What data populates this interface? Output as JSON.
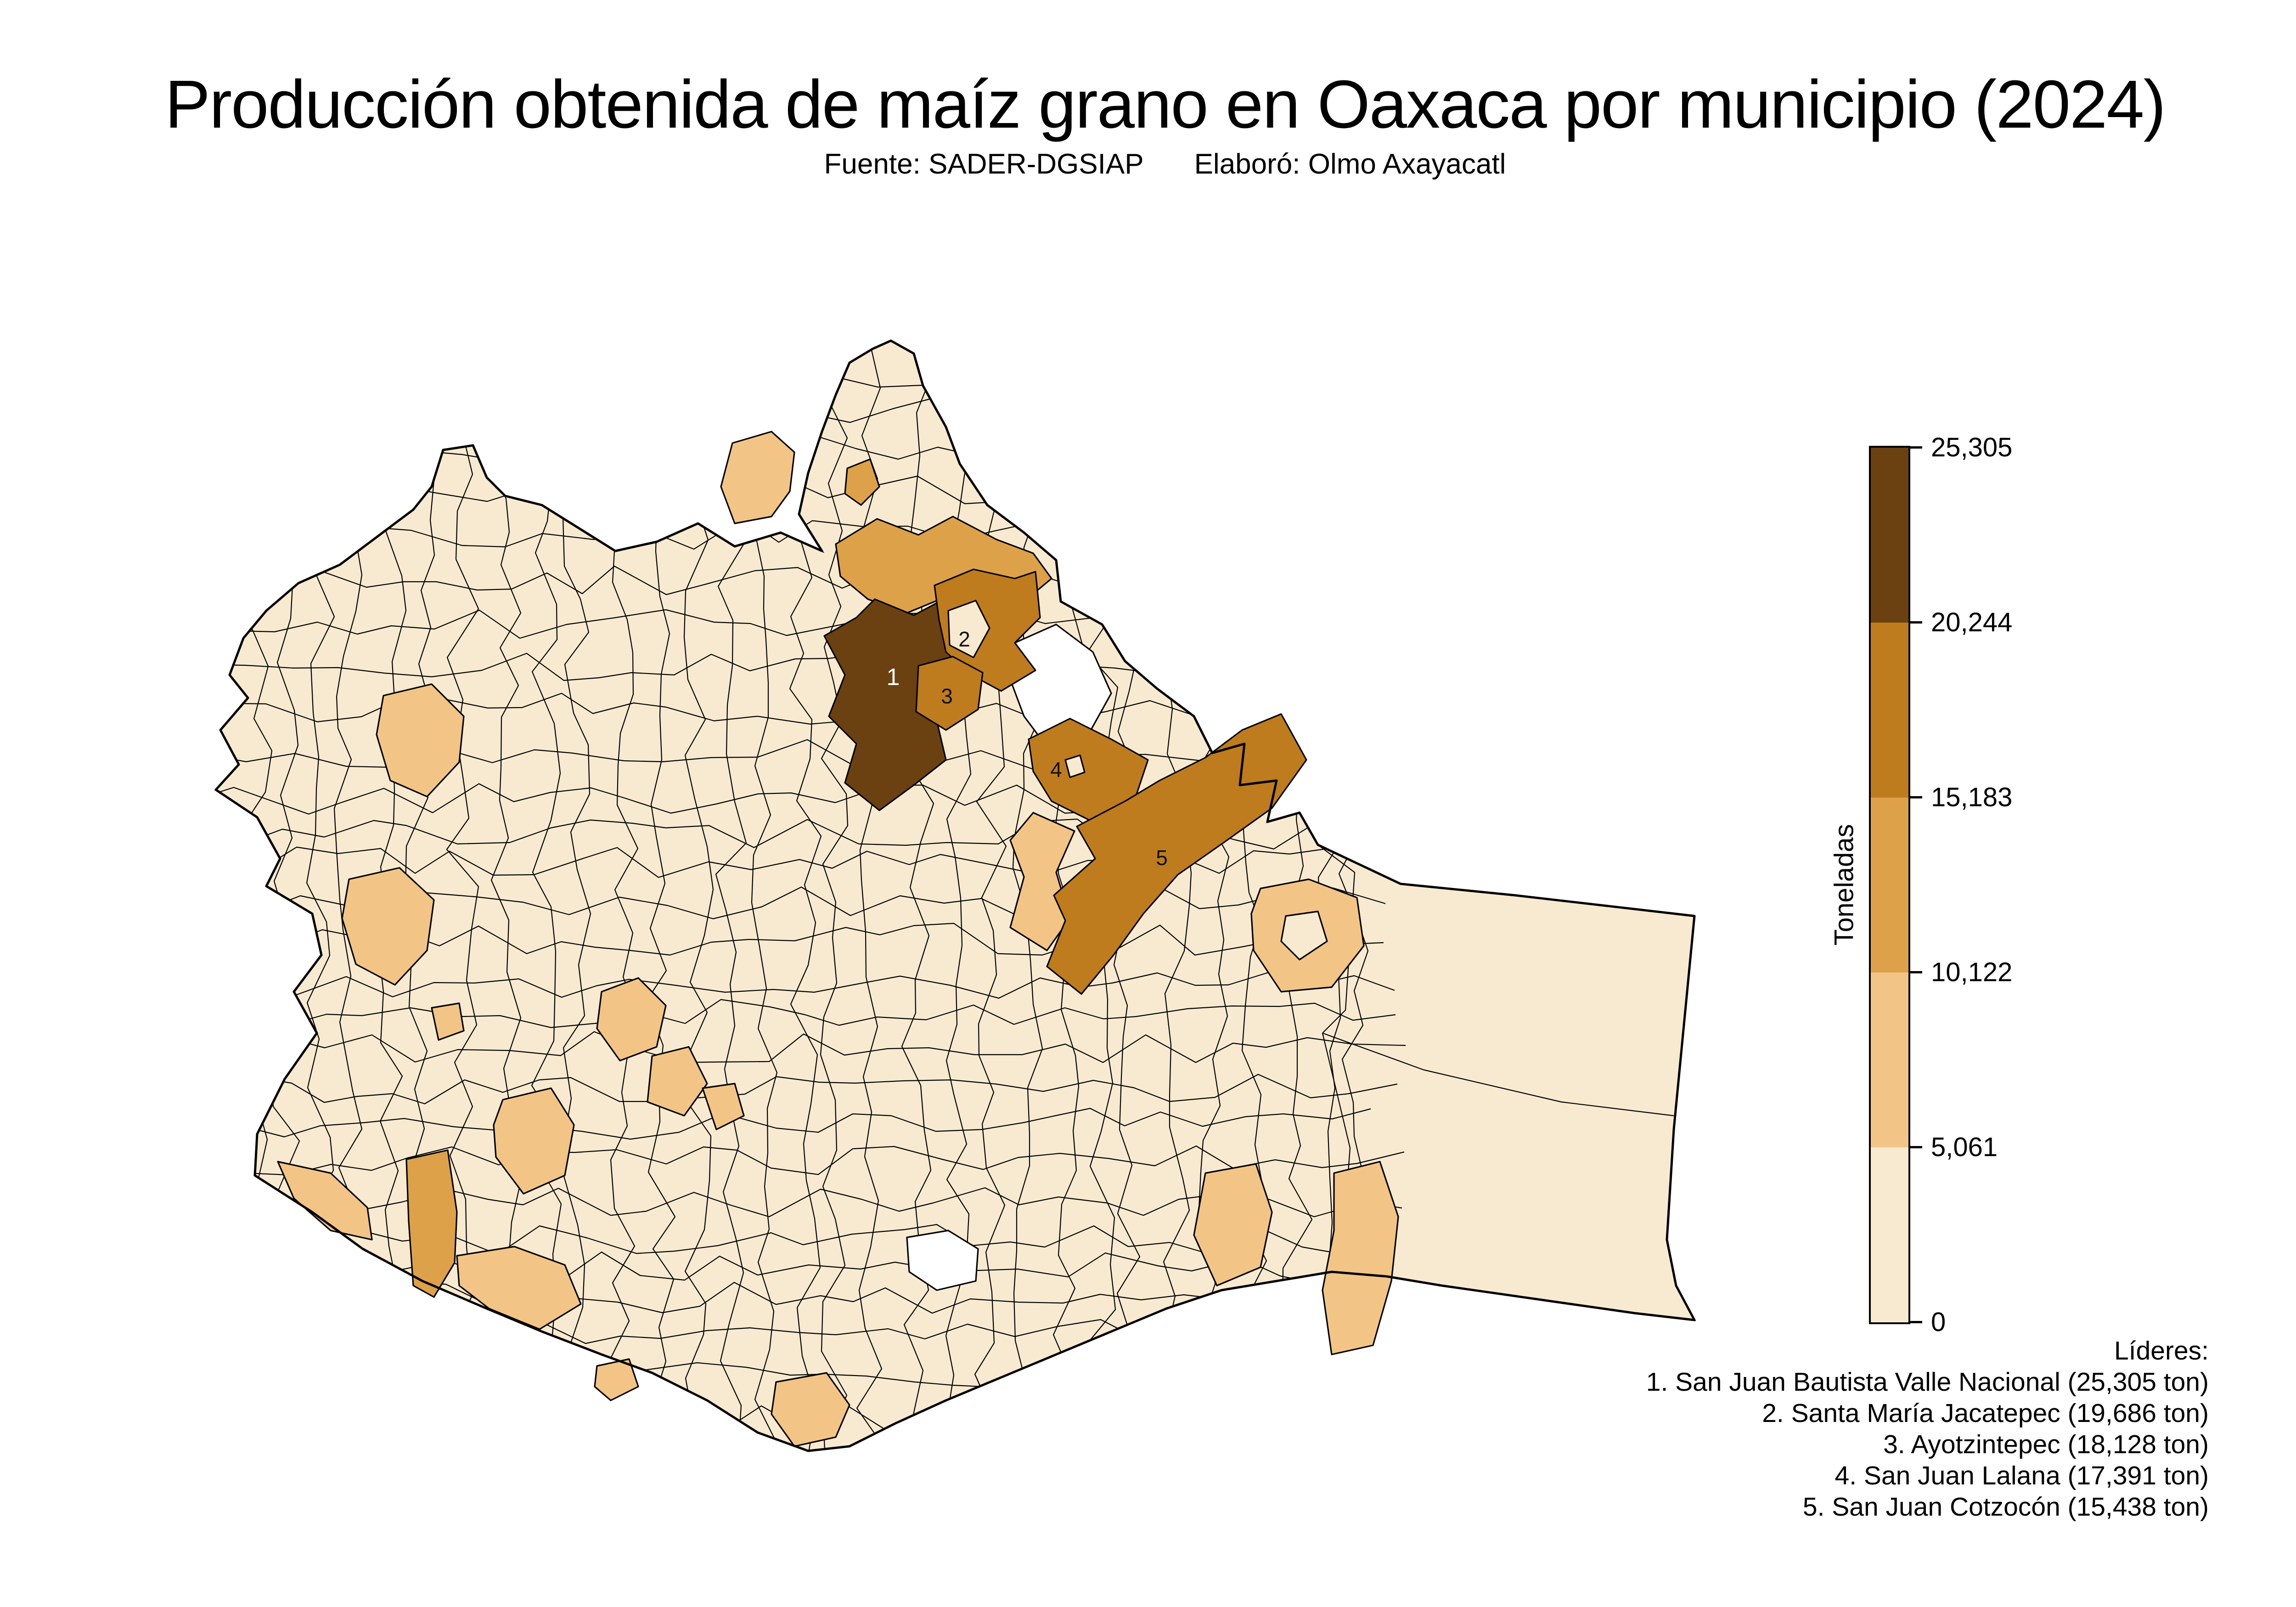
{
  "title": "Producción obtenida de maíz grano en Oaxaca por municipio (2024)",
  "subtitle": {
    "fuente": "Fuente: SADER-DGSIAP",
    "elaboro": "Elaboró: Olmo Axayacatl"
  },
  "colorbar": {
    "label": "Toneladas",
    "ticks": [
      "0",
      "5,061",
      "10,122",
      "15,183",
      "20,244",
      "25,305"
    ]
  },
  "leaders": {
    "heading": "Líderes:",
    "items": [
      "1. San Juan Bautista Valle Nacional (25,305 ton)",
      "2. Santa María Jacatepec (19,686 ton)",
      "3. Ayotzintepec (18,128 ton)",
      "4. San Juan Lalana (17,391 ton)",
      "5. San Juan Cotzocón (15,438 ton)"
    ]
  },
  "map": {
    "markers": [
      {
        "label": "1"
      },
      {
        "label": "2"
      },
      {
        "label": "3"
      },
      {
        "label": "4"
      },
      {
        "label": "5"
      }
    ]
  },
  "chart_data": {
    "type": "choropleth",
    "region": "Oaxaca, México",
    "title": "Producción obtenida de maíz grano en Oaxaca por municipio (2024)",
    "source": "SADER-DGSIAP",
    "author": "Olmo Axayacatl",
    "value_label": "Toneladas",
    "value_range": [
      0,
      25305
    ],
    "bins": [
      0,
      5061,
      10122,
      15183,
      20244,
      25305
    ],
    "bin_colors": [
      "#f8ead0",
      "#f2c586",
      "#dda14a",
      "#bf7c1e",
      "#6b4111"
    ],
    "outside_color": "#ffffff",
    "border_color": "#000000",
    "legend_position": "right",
    "leaders": [
      {
        "rank": 1,
        "municipio": "San Juan Bautista Valle Nacional",
        "toneladas": 25305
      },
      {
        "rank": 2,
        "municipio": "Santa María Jacatepec",
        "toneladas": 19686
      },
      {
        "rank": 3,
        "municipio": "Ayotzintepec",
        "toneladas": 18128
      },
      {
        "rank": 4,
        "municipio": "San Juan Lalana",
        "toneladas": 17391
      },
      {
        "rank": 5,
        "municipio": "San Juan Cotzocón",
        "toneladas": 15438
      }
    ]
  }
}
